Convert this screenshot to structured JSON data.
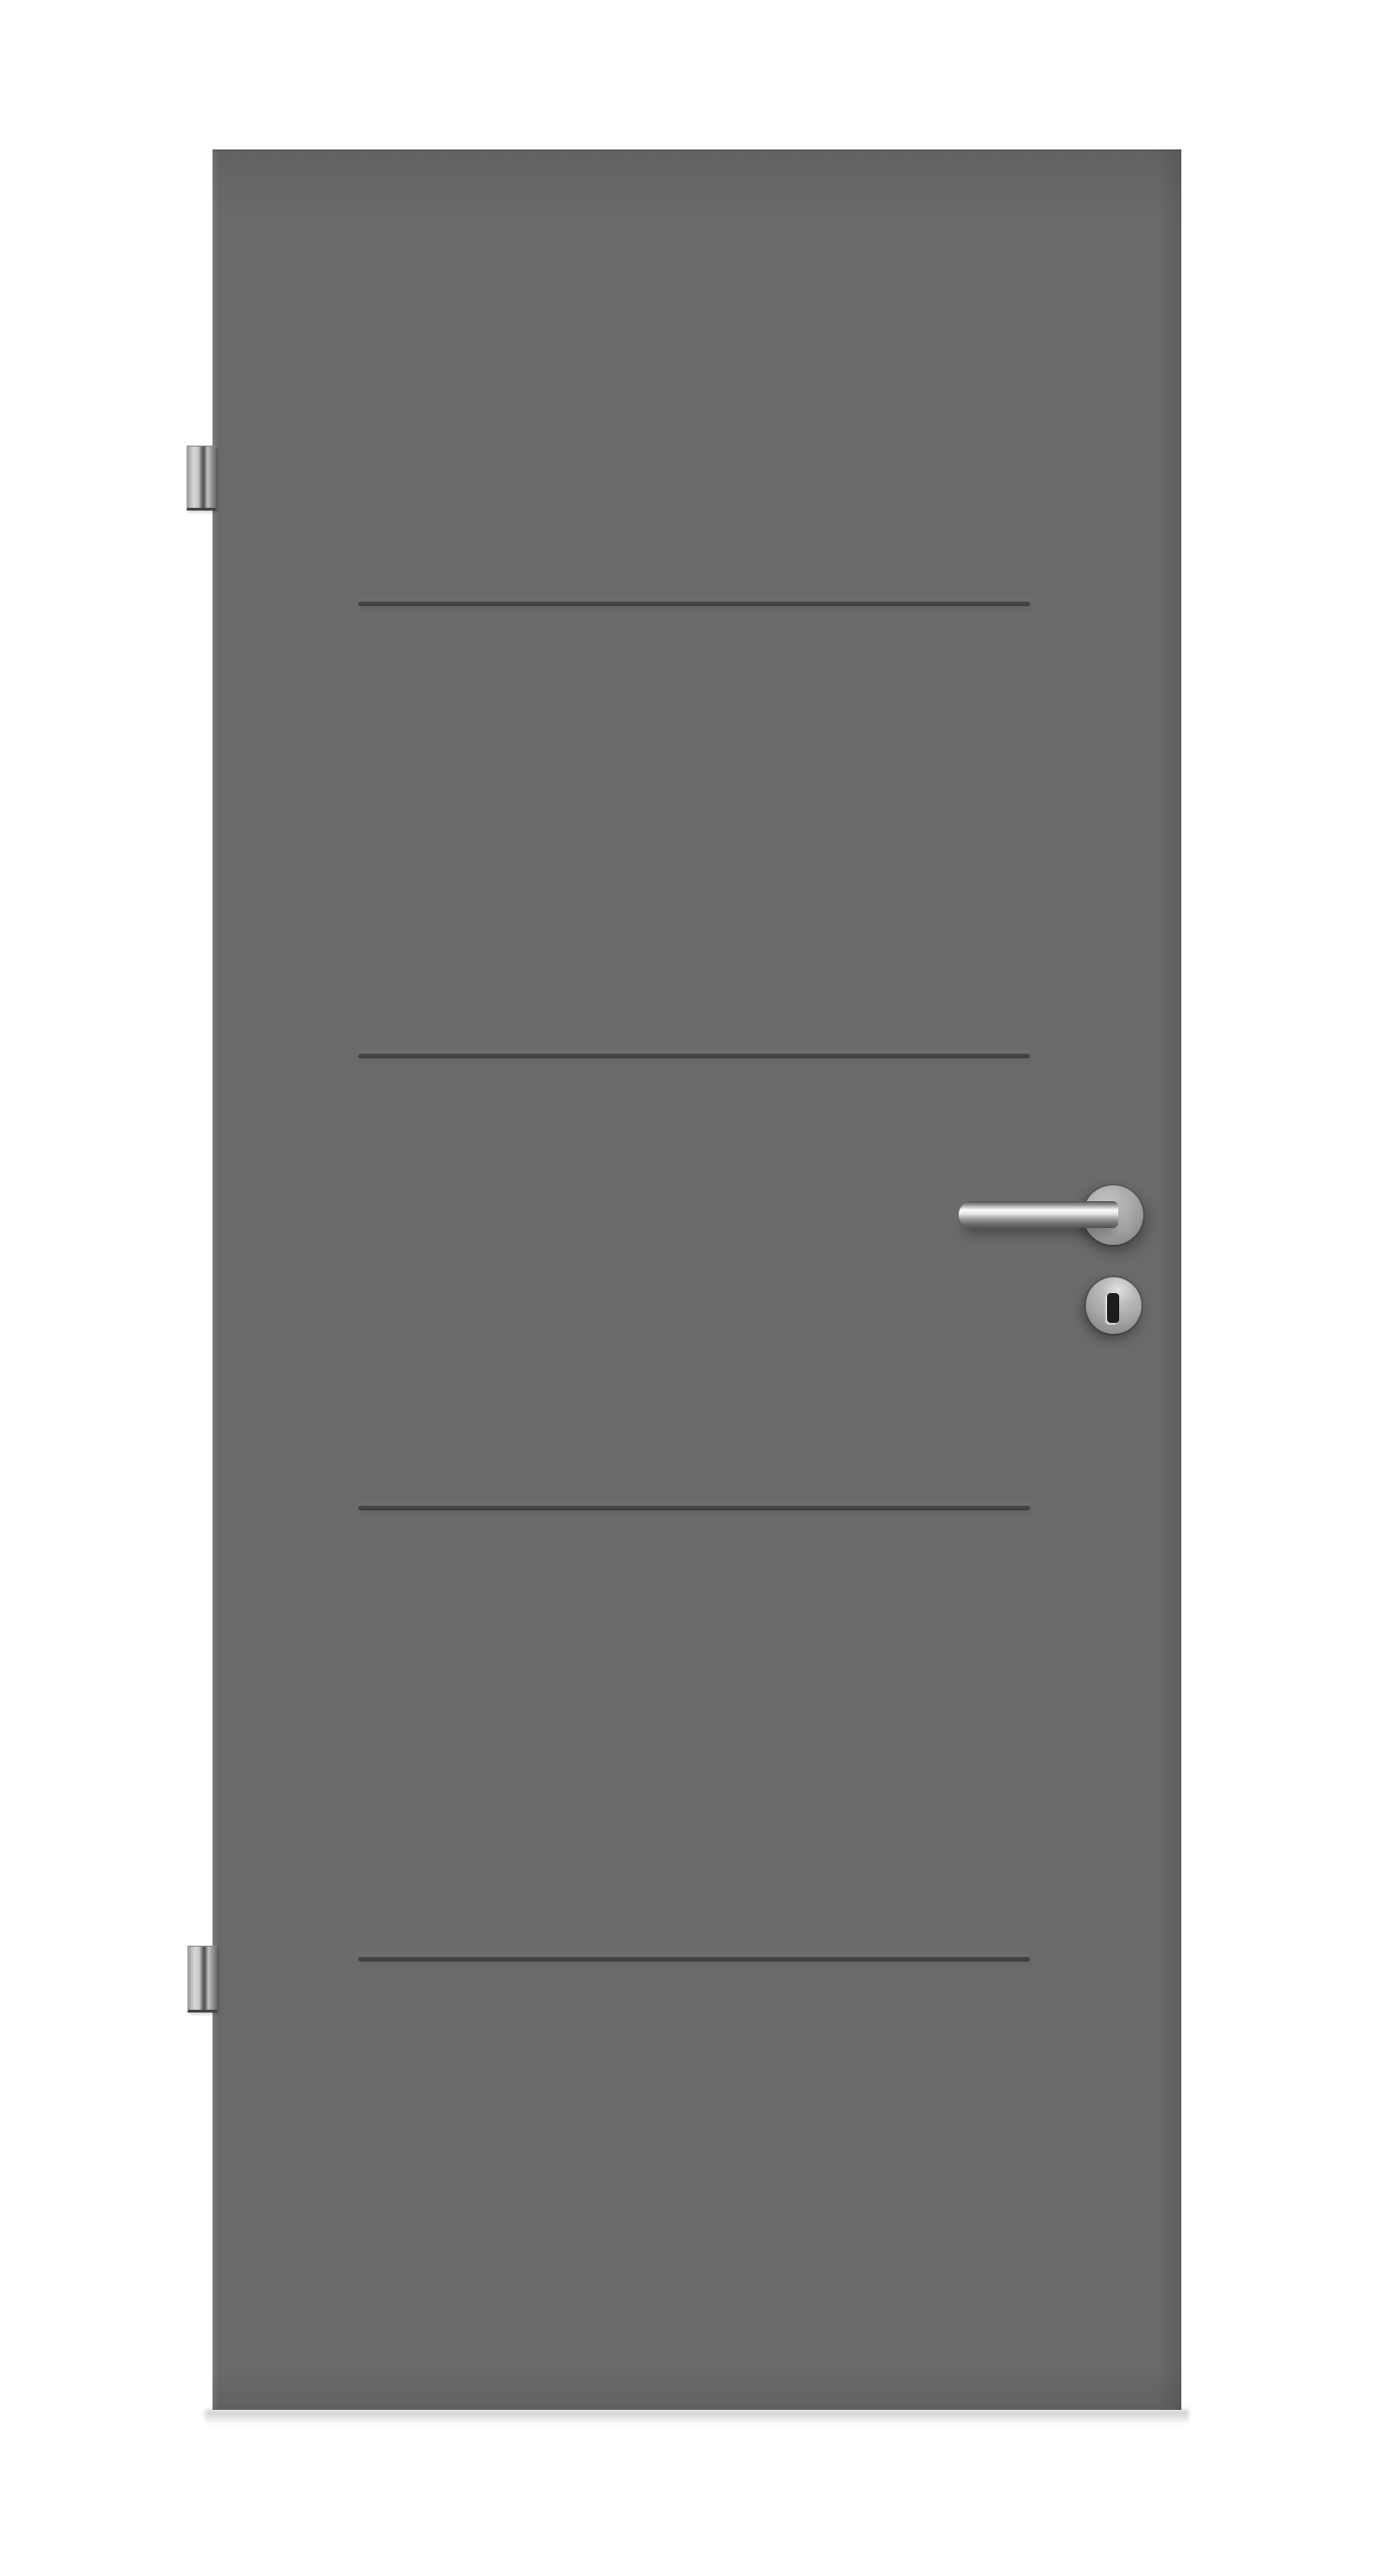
{
  "meta": {
    "description": "Product photo of an anthracite grey interior door leaf on a white background. The flush door has four recessed horizontal groove lines across its upper two-thirds, two stainless steel hinges on the left edge (top and bottom), and on the right side a round-rosette stainless steel lever handle above a profile cylinder key rosette with a vertical keyhole."
  },
  "colors": {
    "background": "#ffffff",
    "door": "#6a6a68",
    "groove": "#3c3c3a",
    "metal_light": "#d8d8d6",
    "metal_mid": "#a7a7a5",
    "metal_dark": "#4f4f4d",
    "keyhole": "#1d1d1b",
    "floor_shadow": "#585856"
  },
  "door": {
    "finish": "anthracite grey",
    "groove_count": 4,
    "hinge_side": "left",
    "hinges": [
      {
        "position": "top"
      },
      {
        "position": "bottom"
      }
    ],
    "hardware": {
      "handle": "round-rosette lever handle, stainless steel",
      "lock": "profile cylinder rosette with keyhole"
    }
  }
}
